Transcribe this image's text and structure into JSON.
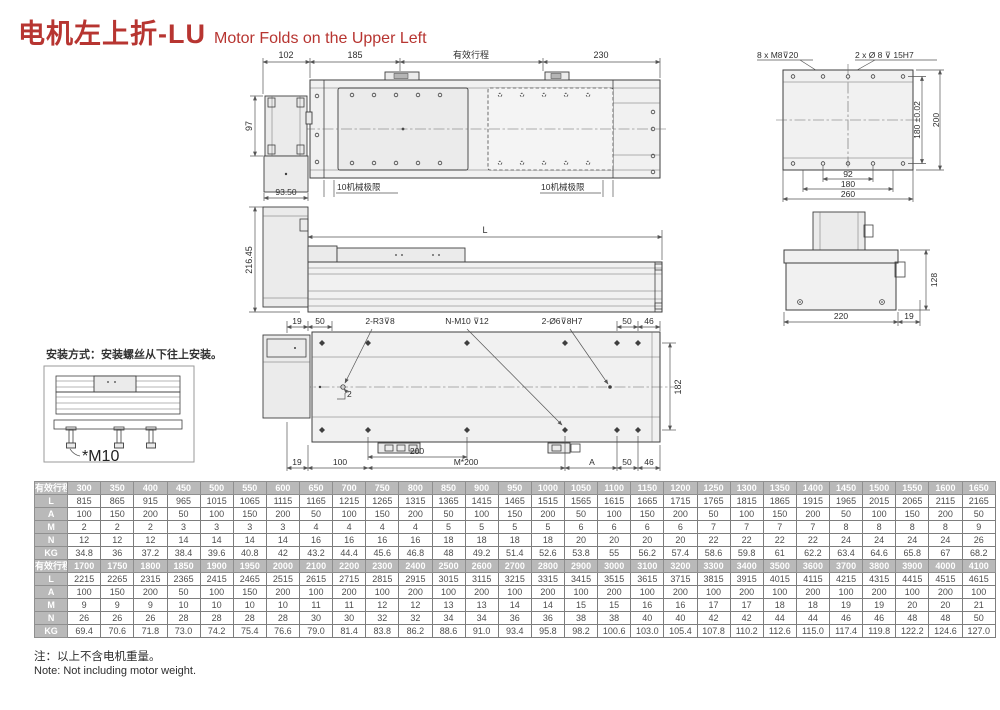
{
  "title": {
    "zh": "电机左上折-LU",
    "en": "Motor Folds on the Upper Left"
  },
  "install": {
    "caption": "安装方式：安装螺丝从下往上安装。",
    "screw_label": "*M10"
  },
  "dims": {
    "top": {
      "left": "102",
      "pitch": "185",
      "stroke": "有效行程",
      "right": "230",
      "motor_h": "97",
      "motor_w": "93.50",
      "limit_left": "10机械极限",
      "limit_right": "10机械极限"
    },
    "side": {
      "length": "L",
      "height": "216.45"
    },
    "plan": {
      "t19": "19",
      "t50": "50",
      "r3": "2-R3⊽8",
      "nm10": "N-M10 ⊽12",
      "d6": "2-Ø6⊽8H7",
      "t50b": "50",
      "t46": "46",
      "w182": "182",
      "b19": "19",
      "b100": "100",
      "b200": "200",
      "m200": "M*200",
      "a": "A",
      "b50": "50",
      "b46": "46",
      "note2": "2"
    },
    "end_top": {
      "screws": "8 x M8⊽20",
      "pins": "2 x Ø 8 ⊽ 15H7",
      "h180": "180 ±0.02",
      "h200": "200",
      "w92": "92",
      "w180": "180",
      "w260": "260"
    },
    "end_mid": {
      "h128": "128",
      "w220": "220",
      "w19": "19"
    }
  },
  "table": {
    "row_headers": [
      "有效行程",
      "L",
      "A",
      "M",
      "N",
      "KG"
    ],
    "banks": [
      [
        [
          "300",
          "350",
          "400",
          "450",
          "500",
          "550",
          "600",
          "650",
          "700",
          "750",
          "800",
          "850",
          "900",
          "950",
          "1000",
          "1050",
          "1100",
          "1150",
          "1200",
          "1250",
          "1300",
          "1350",
          "1400",
          "1450",
          "1500",
          "1550",
          "1600",
          "1650"
        ],
        [
          "815",
          "865",
          "915",
          "965",
          "1015",
          "1065",
          "1115",
          "1165",
          "1215",
          "1265",
          "1315",
          "1365",
          "1415",
          "1465",
          "1515",
          "1565",
          "1615",
          "1665",
          "1715",
          "1765",
          "1815",
          "1865",
          "1915",
          "1965",
          "2015",
          "2065",
          "2115",
          "2165"
        ],
        [
          "100",
          "150",
          "200",
          "50",
          "100",
          "150",
          "200",
          "50",
          "100",
          "150",
          "200",
          "50",
          "100",
          "150",
          "200",
          "50",
          "100",
          "150",
          "200",
          "50",
          "100",
          "150",
          "200",
          "50",
          "100",
          "150",
          "200",
          "50"
        ],
        [
          "2",
          "2",
          "2",
          "3",
          "3",
          "3",
          "3",
          "4",
          "4",
          "4",
          "4",
          "5",
          "5",
          "5",
          "5",
          "6",
          "6",
          "6",
          "6",
          "7",
          "7",
          "7",
          "7",
          "8",
          "8",
          "8",
          "8",
          "9"
        ],
        [
          "12",
          "12",
          "12",
          "14",
          "14",
          "14",
          "14",
          "16",
          "16",
          "16",
          "16",
          "18",
          "18",
          "18",
          "18",
          "20",
          "20",
          "20",
          "20",
          "22",
          "22",
          "22",
          "22",
          "24",
          "24",
          "24",
          "24",
          "26"
        ],
        [
          "34.8",
          "36",
          "37.2",
          "38.4",
          "39.6",
          "40.8",
          "42",
          "43.2",
          "44.4",
          "45.6",
          "46.8",
          "48",
          "49.2",
          "51.4",
          "52.6",
          "53.8",
          "55",
          "56.2",
          "57.4",
          "58.6",
          "59.8",
          "61",
          "62.2",
          "63.4",
          "64.6",
          "65.8",
          "67",
          "68.2"
        ]
      ],
      [
        [
          "1700",
          "1750",
          "1800",
          "1850",
          "1900",
          "1950",
          "2000",
          "2100",
          "2200",
          "2300",
          "2400",
          "2500",
          "2600",
          "2700",
          "2800",
          "2900",
          "3000",
          "3100",
          "3200",
          "3300",
          "3400",
          "3500",
          "3600",
          "3700",
          "3800",
          "3900",
          "4000",
          "4100"
        ],
        [
          "2215",
          "2265",
          "2315",
          "2365",
          "2415",
          "2465",
          "2515",
          "2615",
          "2715",
          "2815",
          "2915",
          "3015",
          "3115",
          "3215",
          "3315",
          "3415",
          "3515",
          "3615",
          "3715",
          "3815",
          "3915",
          "4015",
          "4115",
          "4215",
          "4315",
          "4415",
          "4515",
          "4615"
        ],
        [
          "100",
          "150",
          "200",
          "50",
          "100",
          "150",
          "200",
          "100",
          "200",
          "100",
          "200",
          "100",
          "200",
          "100",
          "200",
          "100",
          "200",
          "100",
          "200",
          "100",
          "200",
          "100",
          "200",
          "100",
          "200",
          "100",
          "200",
          "100"
        ],
        [
          "9",
          "9",
          "9",
          "10",
          "10",
          "10",
          "10",
          "11",
          "11",
          "12",
          "12",
          "13",
          "13",
          "14",
          "14",
          "15",
          "15",
          "16",
          "16",
          "17",
          "17",
          "18",
          "18",
          "19",
          "19",
          "20",
          "20",
          "21"
        ],
        [
          "26",
          "26",
          "26",
          "28",
          "28",
          "28",
          "28",
          "30",
          "30",
          "32",
          "32",
          "34",
          "34",
          "36",
          "36",
          "38",
          "38",
          "40",
          "40",
          "42",
          "42",
          "44",
          "44",
          "46",
          "46",
          "48",
          "48",
          "50"
        ],
        [
          "69.4",
          "70.6",
          "71.8",
          "73.0",
          "74.2",
          "75.4",
          "76.6",
          "79.0",
          "81.4",
          "83.8",
          "86.2",
          "88.6",
          "91.0",
          "93.4",
          "95.8",
          "98.2",
          "100.6",
          "103.0",
          "105.4",
          "107.8",
          "110.2",
          "112.6",
          "115.0",
          "117.4",
          "119.8",
          "122.2",
          "124.6",
          "127.0"
        ]
      ]
    ]
  },
  "notes": {
    "zh": "注：以上不含电机重量。",
    "en": "Note: Not including motor weight."
  },
  "colors": {
    "accent": "#b73531",
    "table_header_bg": "#b9b9b9",
    "table_header_text": "#ffffff",
    "line": "#3f3f3f"
  }
}
